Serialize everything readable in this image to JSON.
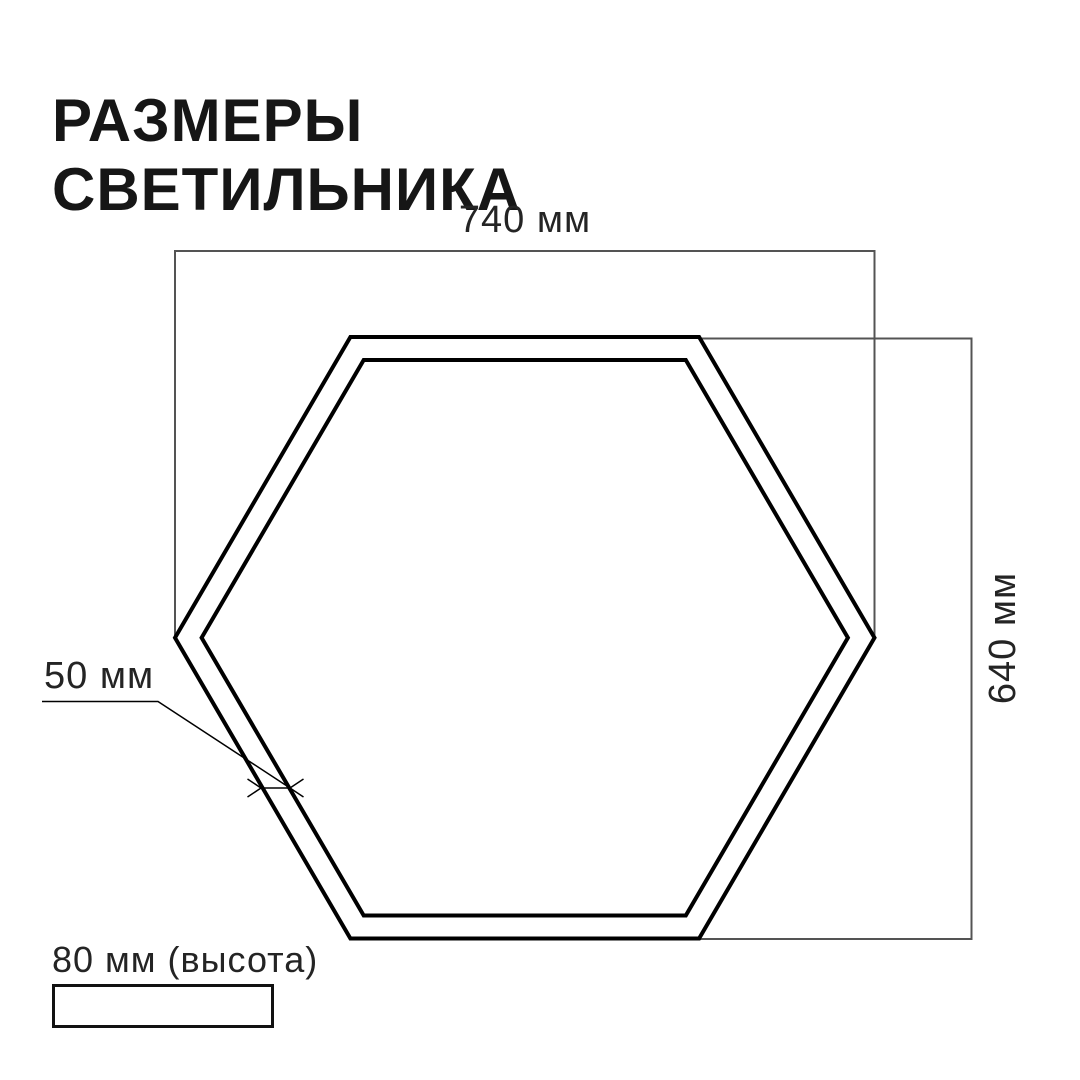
{
  "title": {
    "line1": "РАЗМЕРЫ",
    "line2": "СВЕТИЛЬНИКА"
  },
  "labels": {
    "width": "740 мм",
    "height": "640 мм",
    "profile": "50 мм",
    "depth": "80 мм (высота)"
  },
  "colors": {
    "background": "#ffffff",
    "title_text": "#161616",
    "label_text": "#242424",
    "dimension_line": "#545454",
    "fixture_outline": "#000000"
  }
}
